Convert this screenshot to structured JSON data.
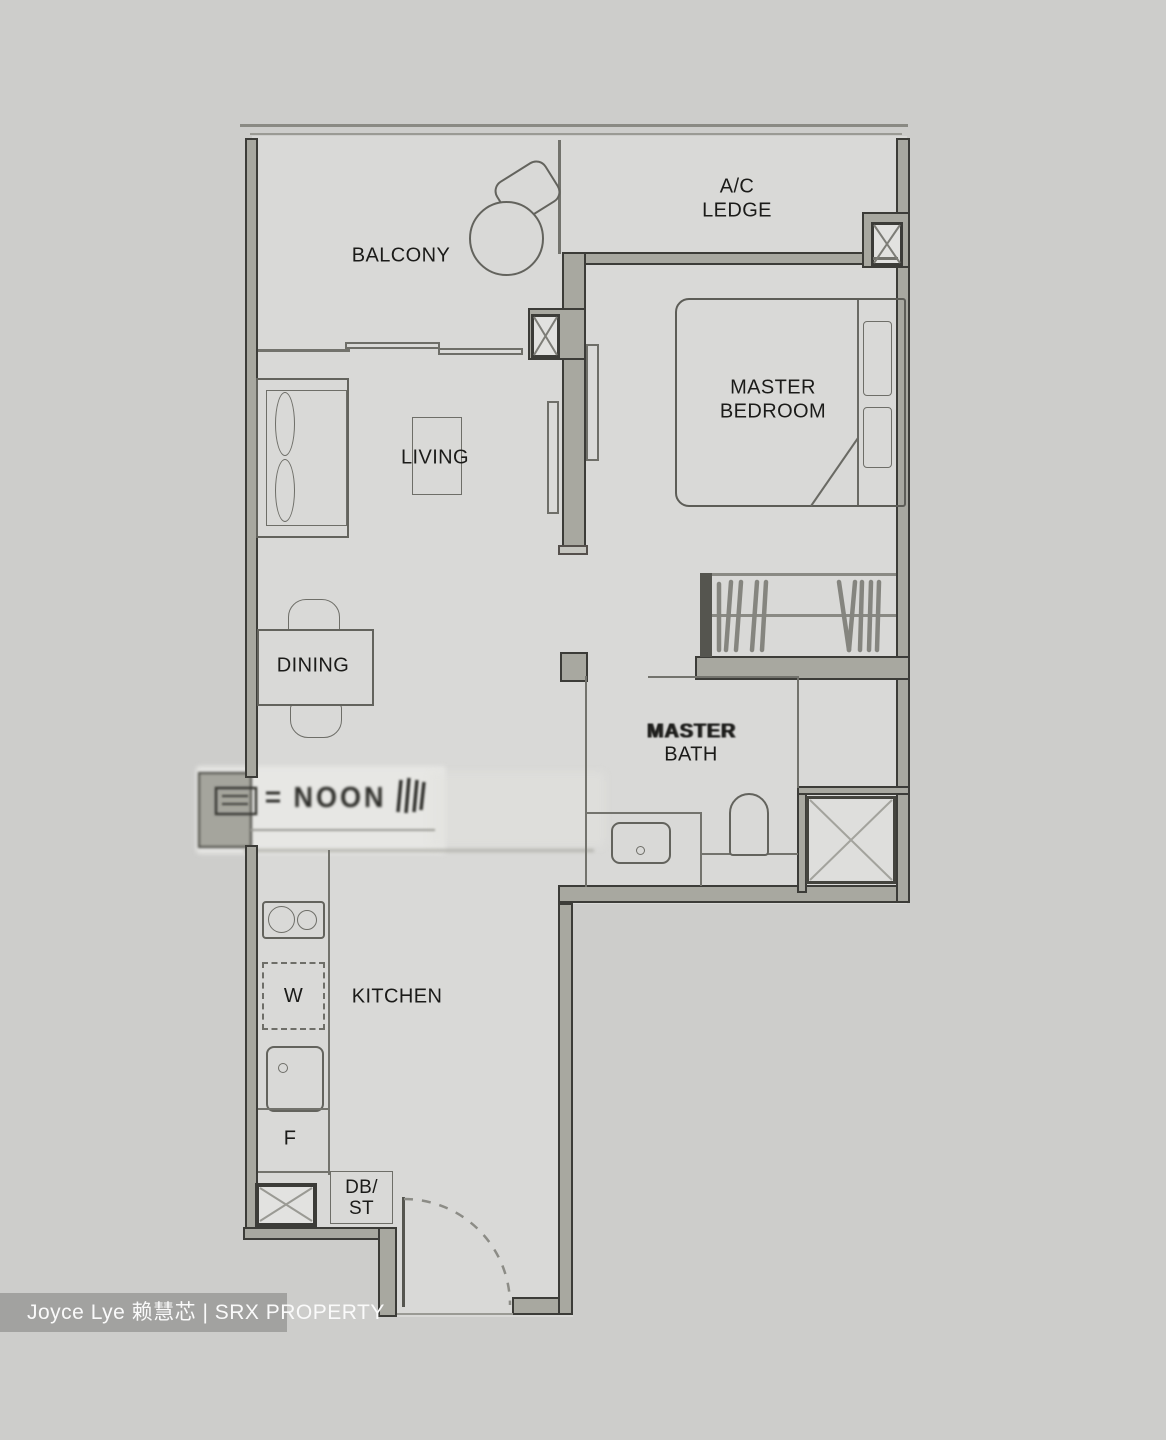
{
  "watermark": {
    "agent": "Joyce Lye 赖慧芯 | SRX PROPERTY"
  },
  "labels": {
    "balcony": "BALCONY",
    "ac_ledge": {
      "l1": "A/C",
      "l2": "LEDGE"
    },
    "master_bedroom": {
      "l1": "MASTER",
      "l2": "BEDROOM"
    },
    "living": "LIVING",
    "dining": "DINING",
    "master_bath": {
      "l1": "MASTER",
      "l2": "BATH"
    },
    "kitchen": "KITCHEN",
    "washer": "W",
    "fridge": "F",
    "db_st": {
      "l1": "DB/",
      "l2": "ST"
    }
  },
  "artifacts": {
    "smudged_text": "NOON"
  },
  "colors": {
    "wall_fill": "#a8a8a0",
    "wall_outline": "#3c3c38",
    "floor": "#d9d9d7",
    "background": "#cdcdcb",
    "thin_line": "#73736d",
    "text": "#1b1b19",
    "watermark_bg": "#a2a2a0",
    "watermark_text": "#fafafa"
  }
}
